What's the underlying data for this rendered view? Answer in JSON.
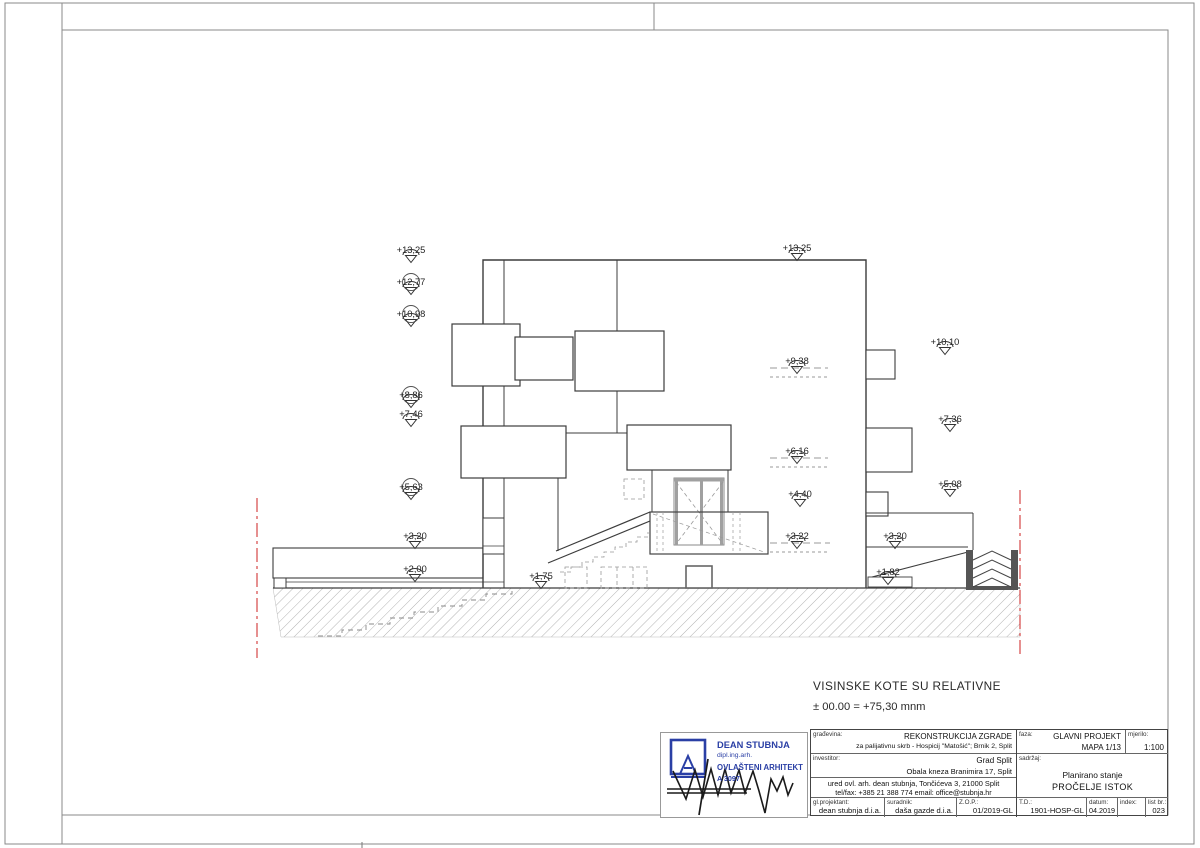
{
  "notes": {
    "line1": "VISINSKE KOTE SU RELATIVNE",
    "line2": "± 00.00 = +75,30 mnm"
  },
  "markers": {
    "left": [
      "+13,25",
      "+12,77",
      "+10,98",
      "+8,86",
      "+7,46",
      "+5,63",
      "+3,20",
      "+2,00",
      "+1,75"
    ],
    "right_inner": [
      "+13,25",
      "+9,38",
      "+6,16",
      "+4,40",
      "+3,22"
    ],
    "right_outer": [
      "+10,10",
      "+7,36",
      "+5,08",
      "+3,20",
      "+1,82"
    ]
  },
  "stamp": {
    "name": "DEAN STUBNJA",
    "title": "dipl.ing.arh.",
    "license": "OVLAŠTENI ARHITEKT",
    "number": "A 3097"
  },
  "titleblock": {
    "gradevina_label": "građevina:",
    "gradevina_line1": "REKONSTRUKCIJA ZGRADE",
    "gradevina_line2": "za palijativnu skrb - Hospicij \"Matošić\"; Brnik 2, Split",
    "faza_label": "faza:",
    "faza_line1": "GLAVNI PROJEKT",
    "faza_line2": "MAPA 1/13",
    "mjerilo_label": "mjerilo:",
    "mjerilo_value": "1:100",
    "investitor_label": "investitor:",
    "investitor_line1": "Grad Split",
    "investitor_line2": "Obala kneza Branimira 17, Split",
    "sadrzaj_label": "sadržaj:",
    "sadrzaj_line1": "Planirano stanje",
    "sadrzaj_line2": "PROČELJE ISTOK",
    "ured_line1": "ured ovl. arh. dean stubnja, Tončićeva 3, 21000 Split",
    "ured_line2": "tel/fax: +385 21 388 774      email: office@stubnja.hr",
    "glprojektant_label": "gl.projektant:",
    "glprojektant_value": "dean stubnja d.i.a.",
    "suradnik_label": "suradnik:",
    "suradnik_value": "daša gazde d.i.a.",
    "zop_label": "Z.O.P.:",
    "zop_value": "01/2019-GL",
    "td_label": "T.D.:",
    "td_value": "1901-HOSP-GL",
    "datum_label": "datum:",
    "datum_value": "04.2019",
    "index_label": "index:",
    "index_value": "",
    "listbr_label": "list br.:",
    "listbr_value": "023"
  }
}
